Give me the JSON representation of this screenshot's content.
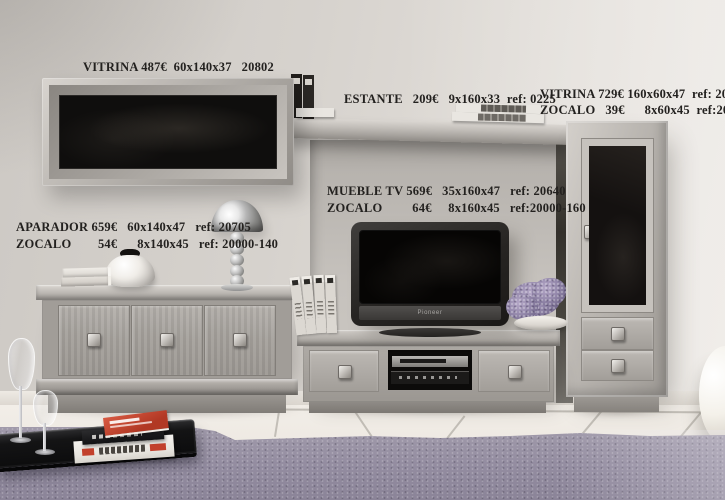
{
  "annotations": {
    "wall_cabinet": {
      "text": "VITRINA 487€  60x140x37   20802"
    },
    "shelf": {
      "text": "ESTANTE   209€   9x160x33  ref: 0225"
    },
    "tall_cabinet": {
      "line1": "VITRINA 729€ 160x60x47  ref: 20231",
      "line2": "ZOCALO   39€      8x60x45  ref:20000-60"
    },
    "sideboard": {
      "line1": "APARADOR 659€   60x140x47   ref: 20705",
      "line2": "ZOCALO        54€      8x140x45   ref: 20000-140"
    },
    "tv_unit": {
      "line1": "MUEBLE TV 569€   35x160x47   ref: 20640",
      "line2": "ZOCALO         64€     8x160x45   ref:20000-160"
    }
  },
  "tv": {
    "brand": "Pioneer"
  },
  "colors": {
    "wall": "#d7d3ce",
    "niche": "#c2beb9",
    "furniture_light": "#cfcbc6",
    "furniture_mid": "#a8a49f",
    "furniture_dark": "#8b8782",
    "glass": "#0f0d0c",
    "floor": "#f0ece6",
    "rug": "#9b95a6",
    "label_text": "#23211f",
    "red_book": "#c0452f"
  }
}
